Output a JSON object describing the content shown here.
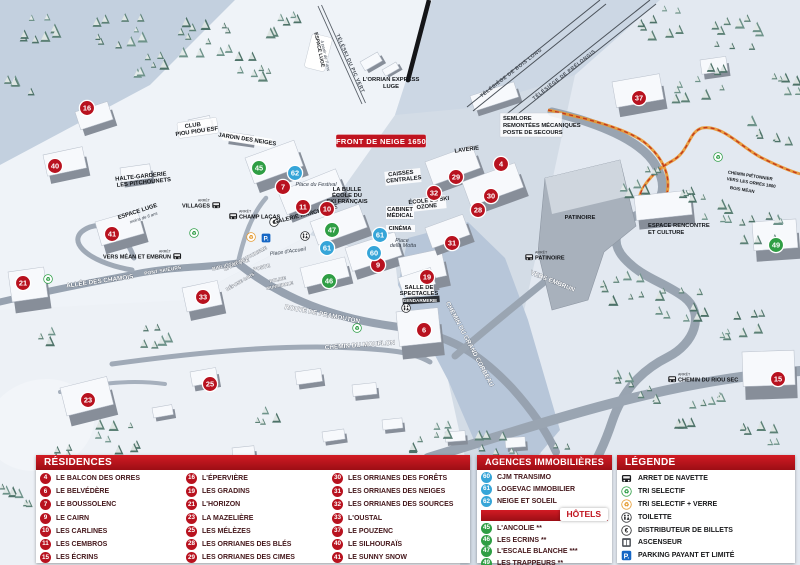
{
  "colors": {
    "residence": "#b8121f",
    "hotel": "#2f9e44",
    "agency": "#36a5d8",
    "header_red": "#b5121b"
  },
  "legend_panels": {
    "residences": {
      "title": "RÉSIDENCES",
      "items": [
        {
          "n": "4",
          "label": "LE BALCON DES ORRES"
        },
        {
          "n": "6",
          "label": "LE BELVÉDÈRE"
        },
        {
          "n": "7",
          "label": "LE BOUSSOLENC"
        },
        {
          "n": "9",
          "label": "LE CAIRN"
        },
        {
          "n": "10",
          "label": "LES CARLINES"
        },
        {
          "n": "11",
          "label": "LES CEMBROS"
        },
        {
          "n": "15",
          "label": "LES ÉCRINS"
        },
        {
          "n": "16",
          "label": "L'ÉPERVIÈRE"
        },
        {
          "n": "19",
          "label": "LES GRADINS"
        },
        {
          "n": "21",
          "label": "L'HORIZON"
        },
        {
          "n": "23",
          "label": "LA MAZELIÈRE"
        },
        {
          "n": "25",
          "label": "LES MÉLÈZES"
        },
        {
          "n": "28",
          "label": "LES ORRIANES DES BLÉS"
        },
        {
          "n": "29",
          "label": "LES ORRIANES DES CIMES"
        },
        {
          "n": "30",
          "label": "LES ORRIANES DES FORÊTS"
        },
        {
          "n": "31",
          "label": "LES ORRIANES DES NEIGES"
        },
        {
          "n": "32",
          "label": "LES ORRIANES DES SOURCES"
        },
        {
          "n": "33",
          "label": "L'OUSTAL"
        },
        {
          "n": "37",
          "label": "LE POUZENC"
        },
        {
          "n": "40",
          "label": "LE SILHOURAÏS"
        },
        {
          "n": "41",
          "label": "LE SUNNY SNOW"
        }
      ]
    },
    "agences": {
      "title": "AGENCES IMMOBILIÈRES",
      "items": [
        {
          "n": "60",
          "label": "CJM TRANSIMO"
        },
        {
          "n": "61",
          "label": "LOGEVAC IMMOBILIER"
        },
        {
          "n": "62",
          "label": "NEIGE ET SOLEIL"
        }
      ]
    },
    "hotels": {
      "title": "HÔTELS",
      "items": [
        {
          "n": "45",
          "label": "L'ANCOLIE **"
        },
        {
          "n": "46",
          "label": "LES ECRINS **"
        },
        {
          "n": "47",
          "label": "L'ESCALE BLANCHE ***"
        },
        {
          "n": "49",
          "label": "LES TRAPPEURS **"
        }
      ]
    },
    "legende": {
      "title": "LÉGENDE",
      "items": [
        {
          "icon": "bus",
          "label": "ARRET DE NAVETTE"
        },
        {
          "icon": "recycle-green",
          "label": "TRI SELECTIF"
        },
        {
          "icon": "recycle-yellow",
          "label": "TRI SELECTIF + VERRE"
        },
        {
          "icon": "wc",
          "label": "TOILETTE"
        },
        {
          "icon": "euro",
          "label": "DISTRIBUTEUR DE BILLETS"
        },
        {
          "icon": "elevator",
          "label": "ASCENSEUR"
        },
        {
          "icon": "parking",
          "label": "PARKING PAYANT ET LIMITÉ"
        }
      ]
    }
  },
  "map": {
    "banner": "FRONT DE NEIGE 1650",
    "markers": [
      {
        "n": "16",
        "x": 87,
        "y": 108,
        "type": "res"
      },
      {
        "n": "40",
        "x": 55,
        "y": 166,
        "type": "res"
      },
      {
        "n": "41",
        "x": 112,
        "y": 234,
        "type": "res"
      },
      {
        "n": "21",
        "x": 23,
        "y": 283,
        "type": "res"
      },
      {
        "n": "23",
        "x": 88,
        "y": 400,
        "type": "res"
      },
      {
        "n": "25",
        "x": 210,
        "y": 384,
        "type": "res"
      },
      {
        "n": "33",
        "x": 203,
        "y": 297,
        "type": "res"
      },
      {
        "n": "7",
        "x": 283,
        "y": 187,
        "type": "res"
      },
      {
        "n": "11",
        "x": 303,
        "y": 207,
        "type": "res"
      },
      {
        "n": "10",
        "x": 327,
        "y": 209,
        "type": "res"
      },
      {
        "n": "9",
        "x": 378,
        "y": 265,
        "type": "res"
      },
      {
        "n": "19",
        "x": 427,
        "y": 277,
        "type": "res"
      },
      {
        "n": "6",
        "x": 424,
        "y": 330,
        "type": "res"
      },
      {
        "n": "31",
        "x": 452,
        "y": 243,
        "type": "res"
      },
      {
        "n": "29",
        "x": 456,
        "y": 177,
        "type": "res"
      },
      {
        "n": "4",
        "x": 501,
        "y": 164,
        "type": "res"
      },
      {
        "n": "32",
        "x": 434,
        "y": 193,
        "type": "res"
      },
      {
        "n": "30",
        "x": 491,
        "y": 196,
        "type": "res"
      },
      {
        "n": "28",
        "x": 478,
        "y": 210,
        "type": "res"
      },
      {
        "n": "37",
        "x": 639,
        "y": 98,
        "type": "res"
      },
      {
        "n": "15",
        "x": 778,
        "y": 379,
        "type": "res"
      },
      {
        "n": "45",
        "x": 259,
        "y": 168,
        "type": "hotel"
      },
      {
        "n": "46",
        "x": 329,
        "y": 281,
        "type": "hotel"
      },
      {
        "n": "47",
        "x": 332,
        "y": 230,
        "type": "hotel"
      },
      {
        "n": "49",
        "x": 776,
        "y": 245,
        "type": "hotel"
      },
      {
        "n": "62",
        "x": 295,
        "y": 173,
        "type": "agency"
      },
      {
        "n": "61",
        "x": 327,
        "y": 248,
        "type": "agency"
      },
      {
        "n": "61",
        "x": 380,
        "y": 235,
        "type": "agency"
      },
      {
        "n": "60",
        "x": 374,
        "y": 253,
        "type": "agency"
      }
    ],
    "bus_stops": [
      {
        "x": 216,
        "y": 205,
        "label": "VILLAGES",
        "side": "left"
      },
      {
        "x": 233,
        "y": 216,
        "label": "CHAMP LACAS",
        "side": "right"
      },
      {
        "x": 177,
        "y": 256,
        "label": "VERS MÉAN ET EMBRUN",
        "side": "left"
      },
      {
        "x": 529,
        "y": 257,
        "label": "PATINOIRE",
        "side": "right"
      },
      {
        "x": 672,
        "y": 379,
        "label": "CHEMIN DU RIOU SEC",
        "side": "right"
      }
    ],
    "stop_prefix": "ARRÊT",
    "poi_icons": [
      {
        "x": 194,
        "y": 233,
        "icon": "recycle-green"
      },
      {
        "x": 48,
        "y": 279,
        "icon": "recycle-green"
      },
      {
        "x": 357,
        "y": 328,
        "icon": "recycle-green"
      },
      {
        "x": 718,
        "y": 157,
        "icon": "recycle-green"
      },
      {
        "x": 251,
        "y": 237,
        "icon": "recycle-yellow"
      },
      {
        "x": 266,
        "y": 238,
        "icon": "parking"
      },
      {
        "x": 274,
        "y": 222,
        "icon": "euro"
      },
      {
        "x": 305,
        "y": 236,
        "icon": "wc"
      },
      {
        "x": 406,
        "y": 308,
        "icon": "wc"
      }
    ],
    "labels": [
      {
        "t": "ESPACE LUGE",
        "x": 318,
        "y": 50,
        "r": 78,
        "c": "s"
      },
      {
        "t": "à partir de 7 ans",
        "x": 324,
        "y": 56,
        "r": 78,
        "c": "i4"
      },
      {
        "t": "TÉLÉSKI DU PIC VERT",
        "x": 349,
        "y": 64,
        "r": 66,
        "c": "l"
      },
      {
        "t": "L'ORRIAN EXPRESS",
        "x": 391,
        "y": 81,
        "c": "f"
      },
      {
        "t": "LUGE",
        "x": 391,
        "y": 88,
        "c": "f"
      },
      {
        "t": "TÉLÉSIÈGE DE BOIS LONG",
        "x": 512,
        "y": 74,
        "r": -38,
        "c": "l"
      },
      {
        "t": "TÉLÉSIÈGE DE PRÉLONGIS",
        "x": 565,
        "y": 76,
        "r": -38,
        "c": "l"
      },
      {
        "t": "SEMLORE",
        "x": 503,
        "y": 120,
        "a": "s",
        "c": "f"
      },
      {
        "t": "REMONTÉES MÉCANIQUES",
        "x": 503,
        "y": 127,
        "a": "s",
        "c": "f"
      },
      {
        "t": "POSTE DE SECOURS",
        "x": 503,
        "y": 134,
        "a": "s",
        "c": "f"
      },
      {
        "t": "CLUB",
        "x": 193,
        "y": 127,
        "r": -8,
        "c": "f"
      },
      {
        "t": "PIOU PIOU ESF",
        "x": 197,
        "y": 133,
        "r": -8,
        "c": "f"
      },
      {
        "t": "JARDIN DES NEIGES",
        "x": 247,
        "y": 141,
        "r": 9,
        "c": "f"
      },
      {
        "t": "HALTE-GARDERIE",
        "x": 141,
        "y": 178,
        "r": -6,
        "c": "f"
      },
      {
        "t": "LES PITCHOUNETS",
        "x": 144,
        "y": 184,
        "r": -6,
        "c": "f"
      },
      {
        "t": "ESPACE LUGE",
        "x": 138,
        "y": 213,
        "r": -18,
        "c": "f"
      },
      {
        "t": "moins de 6 ans",
        "x": 144,
        "y": 219,
        "r": -18,
        "c": "i4"
      },
      {
        "t": "LAVERIE",
        "x": 467,
        "y": 151,
        "r": -8,
        "c": "f"
      },
      {
        "t": "CAISSES",
        "x": 401,
        "y": 175,
        "r": -6,
        "c": "f"
      },
      {
        "t": "CENTRALES",
        "x": 404,
        "y": 181,
        "r": -6,
        "c": "f"
      },
      {
        "t": "LA BULLE",
        "x": 347,
        "y": 191,
        "c": "f"
      },
      {
        "t": "ÉCOLE DU",
        "x": 347,
        "y": 197,
        "c": "f"
      },
      {
        "t": "SKI FRANÇAIS",
        "x": 347,
        "y": 203,
        "c": "f"
      },
      {
        "t": "ÉCOLE DE SKI",
        "x": 429,
        "y": 202,
        "r": -6,
        "c": "f"
      },
      {
        "t": "OZONE",
        "x": 427,
        "y": 208,
        "r": -6,
        "c": "f"
      },
      {
        "t": "CABINET",
        "x": 400,
        "y": 211,
        "c": "f"
      },
      {
        "t": "MÉDICAL",
        "x": 400,
        "y": 217,
        "c": "f"
      },
      {
        "t": "CINÉMA",
        "x": 400,
        "y": 230,
        "c": "f"
      },
      {
        "t": "GALERIE MARCHANDE",
        "x": 306,
        "y": 216,
        "r": -14,
        "c": "f"
      },
      {
        "t": "Place du Festival",
        "x": 316,
        "y": 186,
        "c": "i"
      },
      {
        "t": "Place d'Accueil",
        "x": 288,
        "y": 253,
        "r": -8,
        "c": "i"
      },
      {
        "t": "Place",
        "x": 402,
        "y": 242,
        "c": "i"
      },
      {
        "t": "della Motta",
        "x": 403,
        "y": 247,
        "c": "i"
      },
      {
        "t": "PATINOIRE",
        "x": 580,
        "y": 219,
        "c": "f"
      },
      {
        "t": "ESPACE RENCONTRE",
        "x": 648,
        "y": 227,
        "a": "s",
        "c": "f"
      },
      {
        "t": "ET CULTURE",
        "x": 648,
        "y": 234,
        "a": "s",
        "c": "f"
      },
      {
        "t": "SALLE DE",
        "x": 419,
        "y": 289,
        "c": "f"
      },
      {
        "t": "SPECTACLES",
        "x": 419,
        "y": 295,
        "c": "f"
      },
      {
        "t": "GENDARMERIE",
        "x": 420,
        "y": 302,
        "c": "wd"
      },
      {
        "t": "CHEMIN PIÉTONNIER",
        "x": 750,
        "y": 177,
        "r": 9,
        "c": "f4"
      },
      {
        "t": "VERS LES ORRES 1800",
        "x": 751,
        "y": 184,
        "r": 9,
        "c": "f4"
      },
      {
        "t": "BOIS MÉAN",
        "x": 742,
        "y": 191,
        "r": 9,
        "c": "f4"
      },
      {
        "t": "ALLÉE DES CHAMOIS",
        "x": 100,
        "y": 283,
        "r": -8,
        "c": "w"
      },
      {
        "t": "PONT SKIEURS",
        "x": 163,
        "y": 272,
        "r": -10,
        "c": "w5"
      },
      {
        "t": "BIBLIOTHÈQUE",
        "x": 231,
        "y": 266,
        "r": -14,
        "c": "w5"
      },
      {
        "t": "POSTE",
        "x": 262,
        "y": 269,
        "r": -14,
        "c": "w5"
      },
      {
        "t": "OFFICE DE TOURISME",
        "x": 246,
        "y": 260,
        "r": -28,
        "c": "w4"
      },
      {
        "t": "DÉPOSE CARS",
        "x": 241,
        "y": 283,
        "r": -30,
        "c": "w4"
      },
      {
        "t": "POLICE",
        "x": 278,
        "y": 281,
        "r": -12,
        "c": "w4"
      },
      {
        "t": "MUNICIPALE",
        "x": 280,
        "y": 287,
        "r": -12,
        "c": "w4"
      },
      {
        "t": "ROUTE DE PRAMOUTON",
        "x": 322,
        "y": 316,
        "r": 11,
        "c": "w"
      },
      {
        "t": "CHEMIN DU MOUFLON",
        "x": 360,
        "y": 347,
        "r": -4,
        "c": "w"
      },
      {
        "t": "CHEMIN DU GRAND CORBEAU",
        "x": 468,
        "y": 345,
        "r": 62,
        "c": "w"
      },
      {
        "t": "VERS EMBRUN",
        "x": 552,
        "y": 283,
        "r": 22,
        "c": "w"
      }
    ]
  }
}
